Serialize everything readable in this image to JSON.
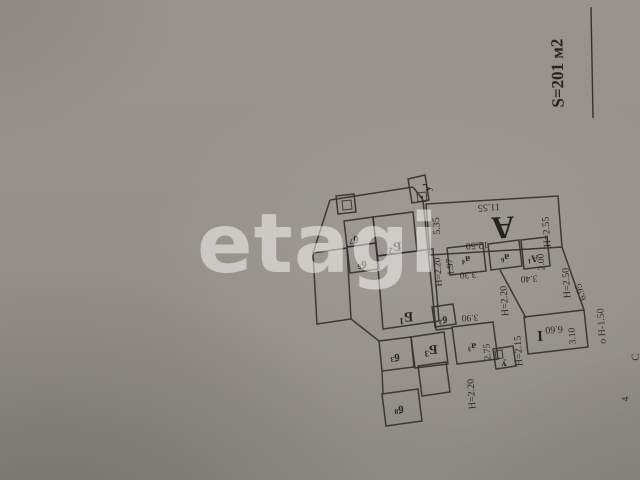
{
  "photo": {
    "paper_color": "#95908a",
    "line_color": "#34312c",
    "text_color": "#24221e"
  },
  "watermark": {
    "text": "etagi"
  },
  "area_note": {
    "text": "S=201 м2"
  },
  "plan": {
    "shapes": [
      {
        "name": "vestibule-u1",
        "points": "408,179 425,175 429,200 412,203",
        "thin": false
      },
      {
        "name": "u1-marker-box",
        "points": "417,193 426,192 427,201 418,202",
        "thin": true
      },
      {
        "name": "stove-outer",
        "points": "336,196 354,194 356,212 338,214",
        "thin": false
      },
      {
        "name": "stove-inner",
        "points": "342,201 351,200 352,209 343,210",
        "thin": true
      },
      {
        "name": "room-b7",
        "points": "344,221 373,217 376,243 347,247",
        "thin": false
      },
      {
        "name": "room-b5",
        "points": "347,247 376,243 379,269 350,273",
        "thin": false
      },
      {
        "name": "room-B2",
        "points": "373,217 413,212 417,251 377,256",
        "thin": false
      },
      {
        "name": "room-B1",
        "points": "377,256 433,249 439,321 383,329",
        "thin": false
      },
      {
        "name": "left-annex",
        "points": "313,253 347,248 351,319 317,324",
        "thin": false
      },
      {
        "name": "room-b3",
        "points": "379,341 411,337 414,367 382,371",
        "thin": false
      },
      {
        "name": "room-B3",
        "points": "411,337 444,332 448,364 415,368",
        "thin": false
      },
      {
        "name": "room-b8",
        "points": "382,394 418,389 422,421 386,426",
        "thin": false
      },
      {
        "name": "porch",
        "points": "418,366 446,362 450,392 422,396",
        "thin": false
      },
      {
        "name": "room-b2",
        "points": "432,307 453,304 456,324 435,327",
        "thin": false
      },
      {
        "name": "room-a3",
        "points": "452,327 493,322 498,359 457,364",
        "thin": false
      },
      {
        "name": "room-u",
        "points": "493,349 513,346 516,366 496,369",
        "thin": false
      },
      {
        "name": "u-marker-box",
        "points": "495,351 502,350 503,358 496,359",
        "thin": true
      },
      {
        "name": "room-I",
        "points": "524,317 584,310 588,347 528,354",
        "thin": false
      },
      {
        "name": "room-a4",
        "points": "447,248 483,244 486,271 450,275",
        "thin": false
      },
      {
        "name": "room-a6",
        "points": "488,244 519,240 522,266 491,270",
        "thin": false
      },
      {
        "name": "room-A1",
        "points": "521,240 547,237 550,266 524,269",
        "thin": false
      },
      {
        "name": "room-A",
        "points": "426,204 558,196 562,247 430,255",
        "thin": false
      }
    ],
    "lines": [
      {
        "name": "wall-left-top",
        "points": "330,200 313,253"
      },
      {
        "name": "wall-top-B",
        "points": "330,200 413,187"
      },
      {
        "name": "wall-join-top",
        "points": "413,187 423,200"
      },
      {
        "name": "wall-corridor",
        "points": "423,200 436,330"
      },
      {
        "name": "wall-corridor-btm",
        "points": "436,330 452,328"
      },
      {
        "name": "wall-east",
        "points": "562,247 584,310"
      },
      {
        "name": "wall-mid",
        "points": "500,270 526,318"
      },
      {
        "name": "wall-sw-diag",
        "points": "351,319 379,341"
      },
      {
        "name": "wall-b3-b8",
        "points": "382,371 383,394"
      }
    ],
    "circles": [
      {
        "name": "u1-marker-dot",
        "cx": 422,
        "cy": 197,
        "r": 1.2
      }
    ],
    "room_labels": [
      {
        "text": "у",
        "sup": "1",
        "x": 428,
        "y": 187,
        "rot": -94,
        "size": 10
      },
      {
        "text": "б",
        "sup": "7",
        "x": 354,
        "y": 239,
        "rot": 177,
        "size": 11
      },
      {
        "text": "б",
        "sup": "5",
        "x": 362,
        "y": 264,
        "rot": 177,
        "size": 11
      },
      {
        "text": "Б",
        "sup": "2",
        "x": 395,
        "y": 247,
        "rot": 177,
        "size": 13
      },
      {
        "text": "Б",
        "sup": "1",
        "x": 406,
        "y": 316,
        "rot": 177,
        "size": 14
      },
      {
        "text": "б",
        "sup": "3",
        "x": 395,
        "y": 357,
        "rot": 177,
        "size": 11
      },
      {
        "text": "Б",
        "sup": "3",
        "x": 431,
        "y": 350,
        "rot": 177,
        "size": 13
      },
      {
        "text": "б",
        "sup": "8",
        "x": 399,
        "y": 409,
        "rot": 177,
        "size": 11
      },
      {
        "text": "б",
        "sup": "2",
        "x": 443,
        "y": 319,
        "rot": 177,
        "size": 10
      },
      {
        "text": "а",
        "sup": "3",
        "x": 472,
        "y": 346,
        "rot": 177,
        "size": 10
      },
      {
        "text": "а",
        "sup": "4",
        "x": 466,
        "y": 259,
        "rot": 177,
        "size": 10
      },
      {
        "text": "а",
        "sup": "6",
        "x": 505,
        "y": 257,
        "rot": 177,
        "size": 10
      },
      {
        "text": "А",
        "sup": "1",
        "x": 533,
        "y": 258,
        "rot": 177,
        "size": 10
      },
      {
        "text": "А",
        "sup": "",
        "x": 503,
        "y": 228,
        "rot": 177,
        "size": 32
      },
      {
        "text": "I",
        "sup": "",
        "x": 540,
        "y": 335,
        "rot": 177,
        "size": 15
      },
      {
        "text": "у",
        "sup": "",
        "x": 504,
        "y": 364,
        "rot": 177,
        "size": 10
      }
    ],
    "dimensions": [
      {
        "text": "11.55",
        "x": 489,
        "y": 207,
        "rot": 177,
        "size": 10
      },
      {
        "text": "5.35",
        "x": 437,
        "y": 226,
        "rot": -94,
        "size": 10
      },
      {
        "text": "12.50",
        "x": 477,
        "y": 245,
        "rot": 177,
        "size": 10
      },
      {
        "text": "Н=2.55",
        "x": 547,
        "y": 232,
        "rot": -94,
        "size": 10
      },
      {
        "text": "Н=2.20",
        "x": 439,
        "y": 272,
        "rot": -94,
        "size": 9.5
      },
      {
        "text": "1.97",
        "x": 451,
        "y": 267,
        "rot": -94,
        "size": 9.5
      },
      {
        "text": "3.30",
        "x": 468,
        "y": 274,
        "rot": 177,
        "size": 9.5
      },
      {
        "text": "3.40",
        "x": 529,
        "y": 278,
        "rot": 177,
        "size": 9.5
      },
      {
        "text": "2.00",
        "x": 542,
        "y": 262,
        "rot": -94,
        "size": 9.5
      },
      {
        "text": "Н=2.50",
        "x": 567,
        "y": 283,
        "rot": -94,
        "size": 10
      },
      {
        "text": "6.95",
        "x": 581,
        "y": 292,
        "rot": -110,
        "size": 10
      },
      {
        "text": "Н=2.20",
        "x": 505,
        "y": 301,
        "rot": -94,
        "size": 10
      },
      {
        "text": "3.90",
        "x": 470,
        "y": 317,
        "rot": 177,
        "size": 9.5
      },
      {
        "text": "2.75",
        "x": 488,
        "y": 352,
        "rot": -94,
        "size": 9.5
      },
      {
        "text": "Н=2.15",
        "x": 519,
        "y": 351,
        "rot": -94,
        "size": 10
      },
      {
        "text": "6.60",
        "x": 554,
        "y": 329,
        "rot": 177,
        "size": 10
      },
      {
        "text": "3.10",
        "x": 573,
        "y": 336,
        "rot": -94,
        "size": 9.5
      },
      {
        "text": "Н=2.20",
        "x": 472,
        "y": 394,
        "rot": -94,
        "size": 10
      }
    ],
    "outside_labels": [
      {
        "text": "о Н-1.50",
        "x": 602,
        "y": 326,
        "rot": -94,
        "size": 10
      },
      {
        "text": "С",
        "x": 636,
        "y": 357,
        "rot": -94,
        "size": 11
      },
      {
        "text": "4",
        "x": 626,
        "y": 399,
        "rot": -94,
        "size": 10
      }
    ]
  }
}
